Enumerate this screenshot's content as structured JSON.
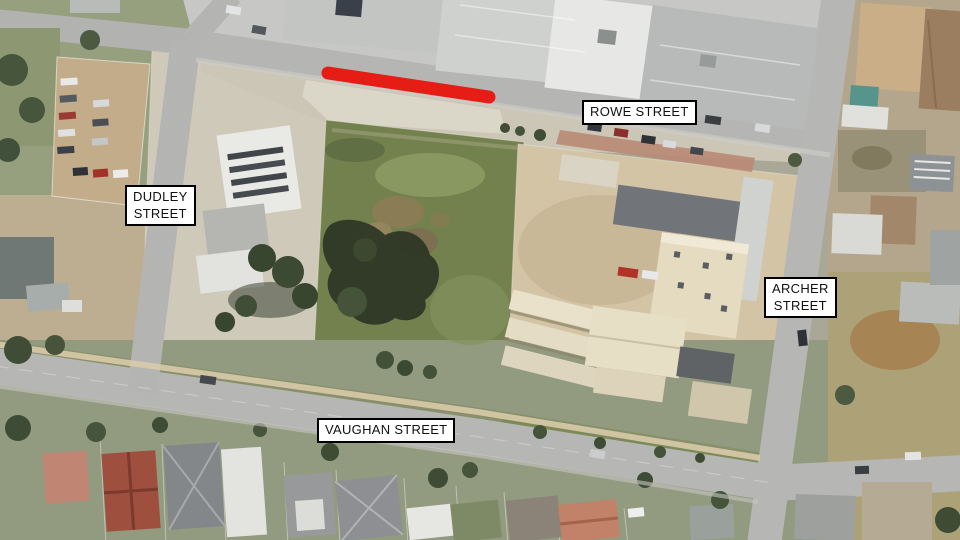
{
  "map": {
    "streets": {
      "rowe": {
        "lines": [
          "ROWE STREET"
        ]
      },
      "dudley": {
        "lines": [
          "DUDLEY",
          "STREET"
        ]
      },
      "archer": {
        "lines": [
          "ARCHER",
          "STREET"
        ]
      },
      "vaughan": {
        "lines": [
          "VAUGHAN STREET"
        ]
      }
    },
    "highlight": {
      "name": "highlighted-road-segment",
      "street": "ROWE STREET",
      "color": "#e8150c"
    },
    "colors": {
      "label_background": "#ffffff",
      "label_border": "#000000",
      "label_text": "#111111",
      "road": "#b5b5b3",
      "grass_lot": "#73814e",
      "highlight_red": "#e8150c"
    }
  }
}
